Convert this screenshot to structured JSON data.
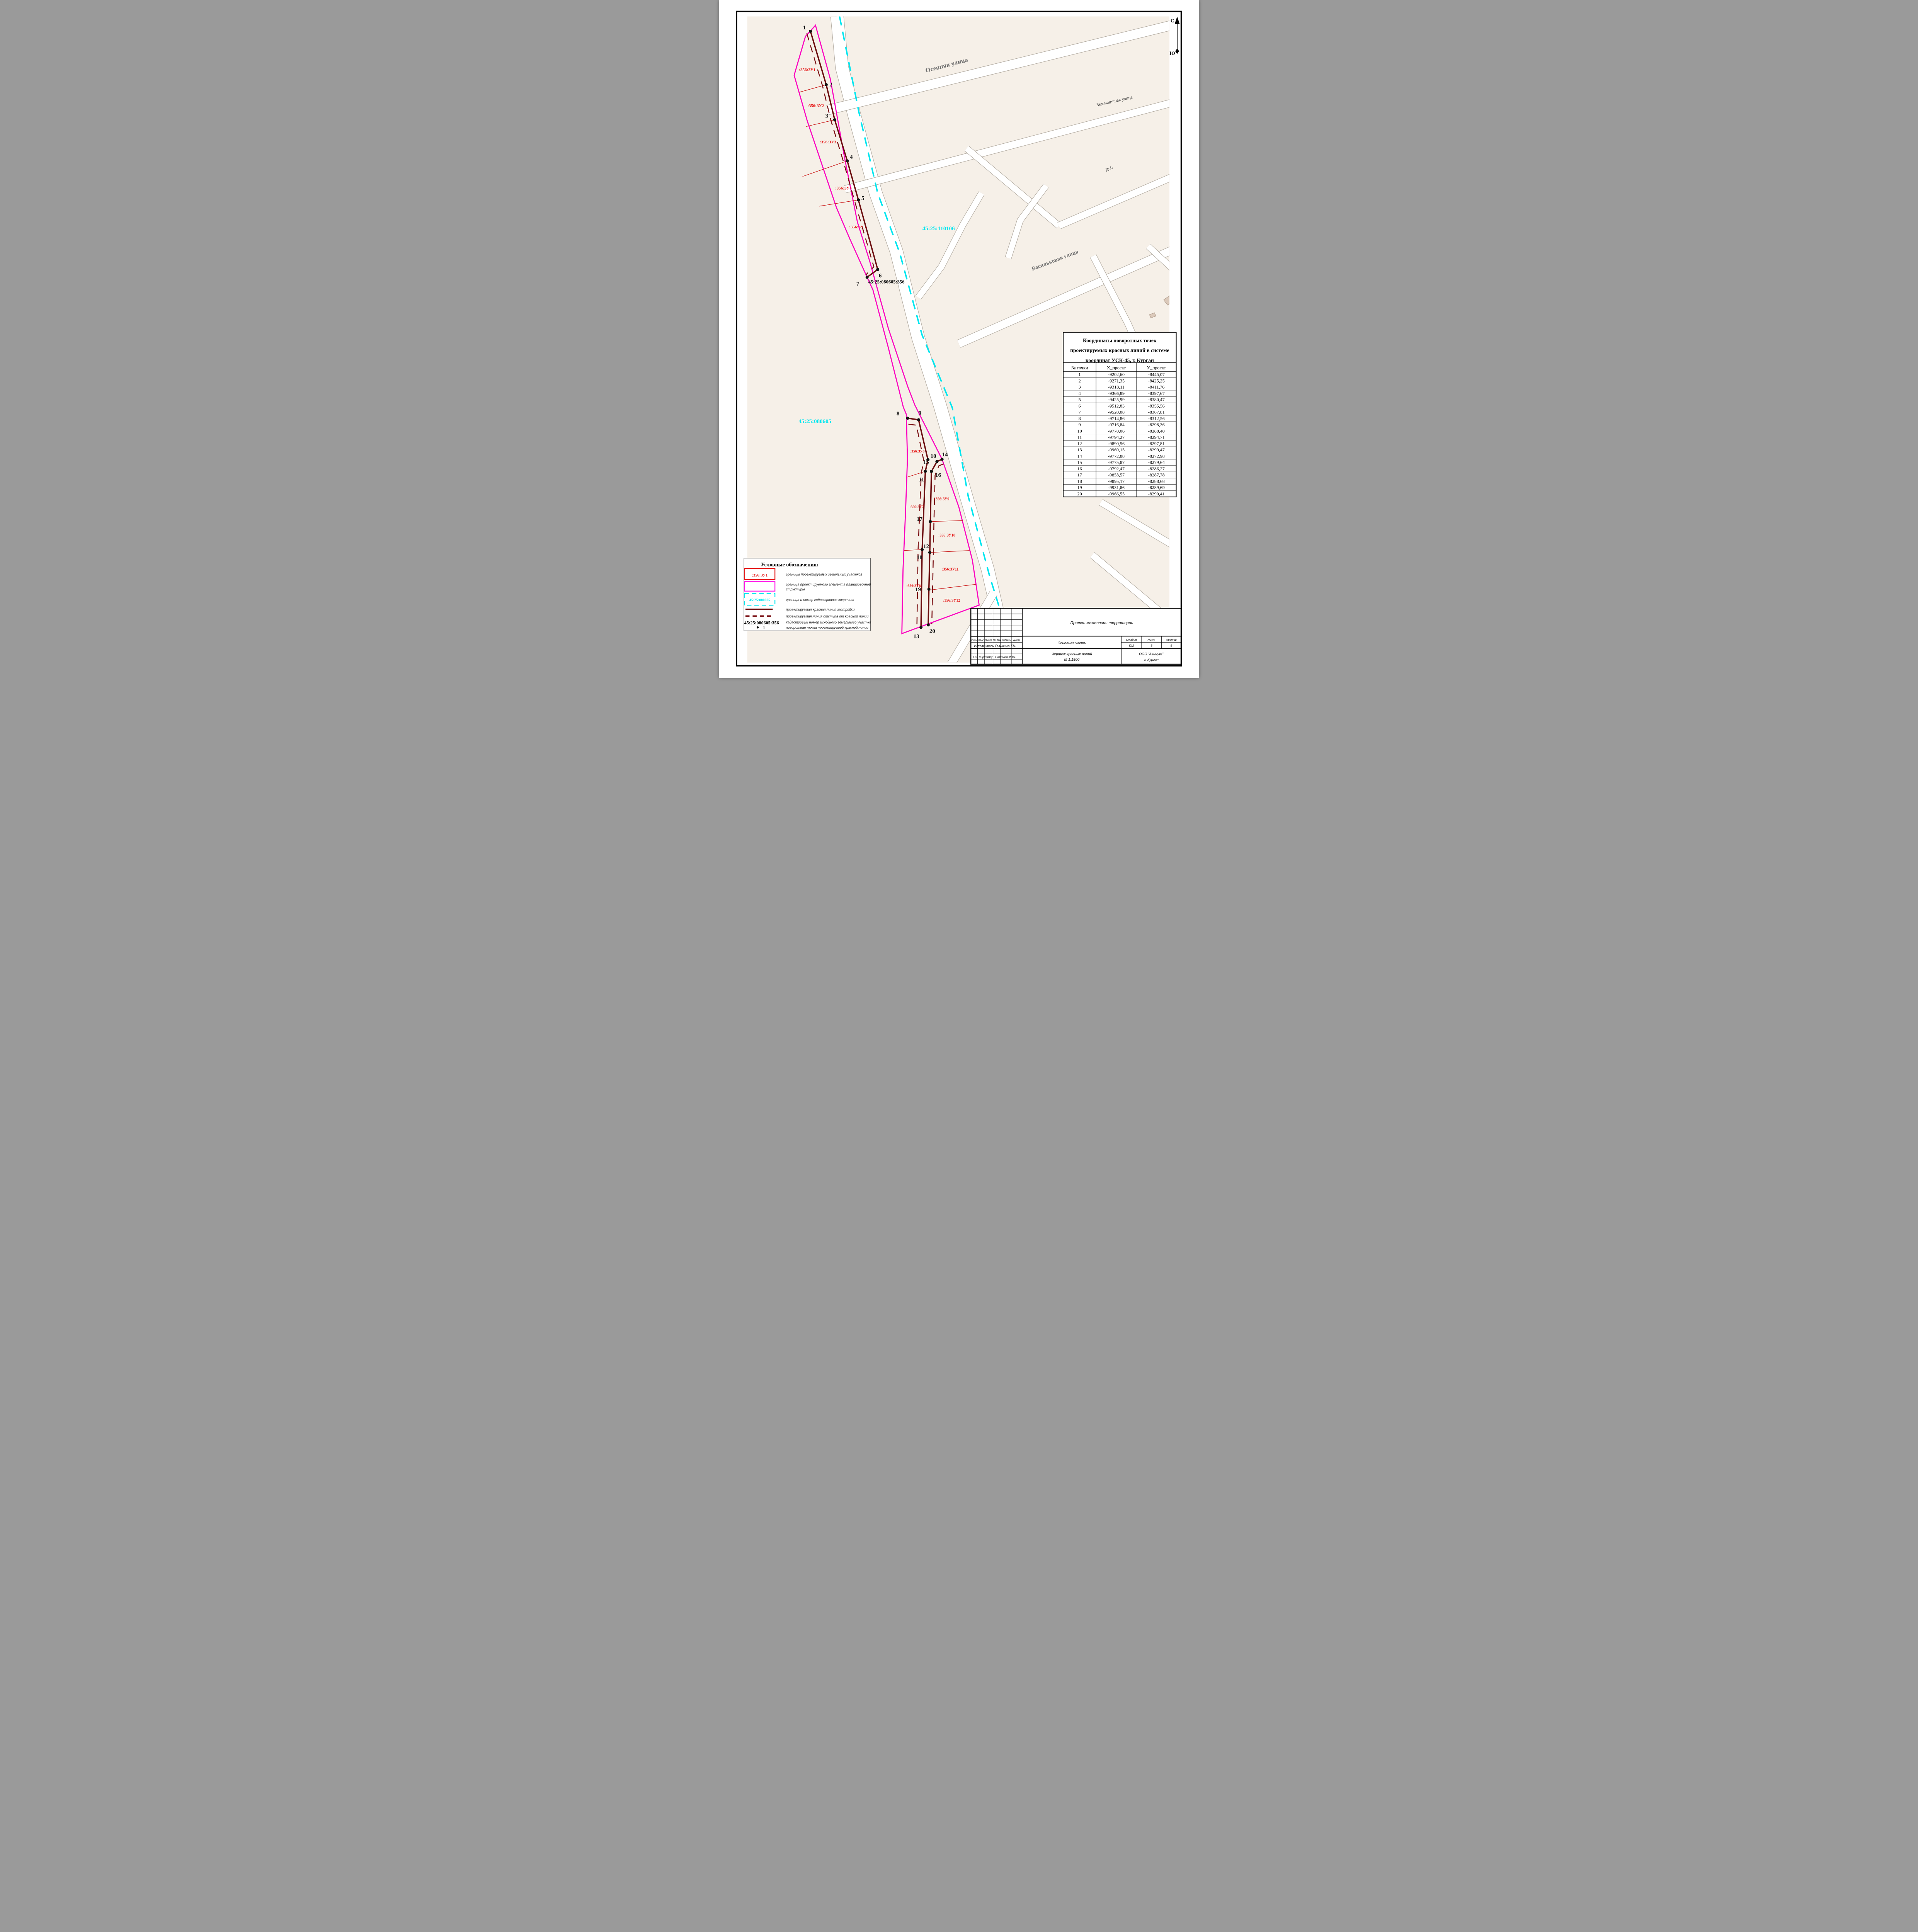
{
  "north": {
    "n": "С",
    "s": "Ю"
  },
  "quarters": {
    "q_upper": "45:25:110106",
    "q_lower": "45:25:080605",
    "source_parcel": "45:25:080605:356"
  },
  "streets": {
    "osennaya": "Осенняя улица",
    "zemlyanichnaya": "Земляничная улица",
    "dobr": "Доб",
    "vasilkovaya": "Васильковая улица"
  },
  "parcels": [
    ":356:ЗУ1",
    ":356:ЗУ2",
    ":356:ЗУ3",
    ":356:ЗУ4",
    ":356:ЗУ5",
    ":356:ЗУ6",
    ":356:ЗУ7",
    ":356:ЗУ8",
    ":356:ЗУ9",
    ":356:ЗУ10",
    ":356:ЗУ11",
    ":356:ЗУ12"
  ],
  "table": {
    "title_lines": [
      "Координаты поворотных точек",
      "проектируемых красных линий в системе",
      "координат УСК-45, г. Курган"
    ],
    "headers": [
      "№ точки",
      "Х_проект",
      "У_проект"
    ],
    "rows": [
      [
        "1",
        "-9202,60",
        "-8445,07"
      ],
      [
        "2",
        "-9271,35",
        "-8425,25"
      ],
      [
        "3",
        "-9318,11",
        "-8411,76"
      ],
      [
        "4",
        "-9366,89",
        "-8397,67"
      ],
      [
        "5",
        "-9425,99",
        "-8380,47"
      ],
      [
        "6",
        "-9512,83",
        "-8355,56"
      ],
      [
        "7",
        "-9520,08",
        "-8367,81"
      ],
      [
        "8",
        "-9714,86",
        "-8312,56"
      ],
      [
        "9",
        "-9716,84",
        "-8298,36"
      ],
      [
        "10",
        "-9770,06",
        "-8288,40"
      ],
      [
        "11",
        "-9794,27",
        "-8294,71"
      ],
      [
        "12",
        "-9890,56",
        "-8297,81"
      ],
      [
        "13",
        "-9969,15",
        "-8299,47"
      ],
      [
        "14",
        "-9772,88",
        "-8272,98"
      ],
      [
        "15",
        "-9775,87",
        "-8279,64"
      ],
      [
        "16",
        "-9792,47",
        "-8286,27"
      ],
      [
        "17",
        "-9853,57",
        "-8287,78"
      ],
      [
        "18",
        "-9895,17",
        "-8288,68"
      ],
      [
        "19",
        "-9931,86",
        "-8289,69"
      ],
      [
        "20",
        "-9966,55",
        "-8290,41"
      ]
    ]
  },
  "legend": {
    "title": "Условные обозначения:",
    "parcel_symbol": ":356:ЗУ1",
    "quarter_symbol": "45:25:080605",
    "cadastral_number": "45:25:080605:356",
    "point_number": "1",
    "item1": "границы проектируемых земельных участков",
    "item2a": "граница проектируемого элемента планировочной",
    "item2b": "структуры",
    "item3": "граница и номер кадастрового квартала",
    "item4": "проектируемая красная линия застройки",
    "item5": "проектируемая линия отступа от красной линии",
    "item6": "кадастровый номер исходного земельного участка",
    "item7": "поворотная точка проектируемой красной линии"
  },
  "titleblock": {
    "project": "Проект межевания территории",
    "rev_headers": [
      "Изм.",
      "Кол.уч.",
      "Лист.",
      "№ док",
      "Подпись",
      "Дата"
    ],
    "executor_label": "Исполнитель",
    "executor_name": "Гальченко Т.Н.",
    "director_label": "Ген.директор",
    "director_name": "Пахомов М.Ю.",
    "section": "Основная часть",
    "stage_header": "Стадия",
    "sheet_header": "Лист",
    "sheets_header": "Листов",
    "stage": "ПМ",
    "sheet": "3",
    "sheets": "5",
    "drawing_title": "Чертеж красных линий",
    "scale": "М 1:1500",
    "company": "ООО \"Азимут\"",
    "city": "г. Курган"
  },
  "colors": {
    "beige": "#f6f0e8",
    "street_casing": "#b5aea4",
    "cyan": "#00e6ef",
    "magenta": "#fb00c0",
    "parcel_red": "#e51616",
    "dark_red": "#6c0e10",
    "thin_red": "#c81414",
    "street_label": "#6e6e6e",
    "building": "#dbc9ba"
  }
}
